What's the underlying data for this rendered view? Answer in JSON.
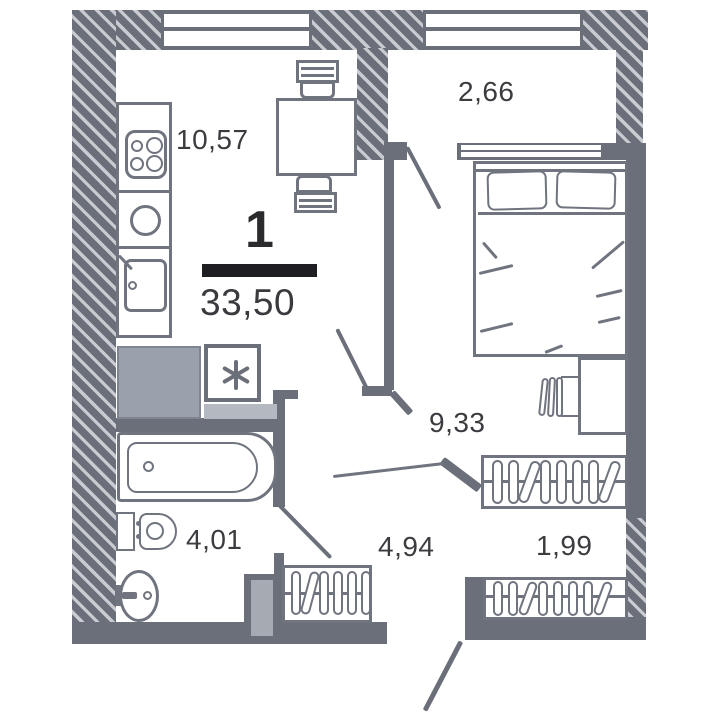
{
  "floor_plan": {
    "type_label": "1",
    "total_area": "33,50",
    "areas": {
      "kitchen_living": "10,57",
      "balcony": "2,66",
      "room": "9,33",
      "bathroom": "4,01",
      "hallway": "4,94",
      "wardrobe": "1,99"
    },
    "colors": {
      "wall": "#6b6f7a",
      "hatch_stripe": "#c9cbd1",
      "furniture_outline": "#70747f",
      "appliance_fill": "#9ba1ac",
      "counter_fill": "#b4b8c0",
      "text": "#3c3c40",
      "divider_bar": "#1f1f23",
      "background": "#ffffff"
    },
    "icons": {
      "washing_machine": "six-spoke-asterisk",
      "stove": "four-burner-circles",
      "kitchen_sink": "circle-basin",
      "prep_sink": "square-basin-with-faucet",
      "bathtub": "tub-outline-with-drain",
      "toilet": "tank-and-bowl",
      "washbasin": "oval-basin-with-faucet",
      "dining_table": "square-table-two-chairs",
      "double_bed": "bed-with-two-pillows",
      "desk": "rectangle-desk",
      "desk_chair": "slatted-chair",
      "wardrobe": "hanger-oval-row",
      "door": "quarter-swing-line"
    }
  }
}
